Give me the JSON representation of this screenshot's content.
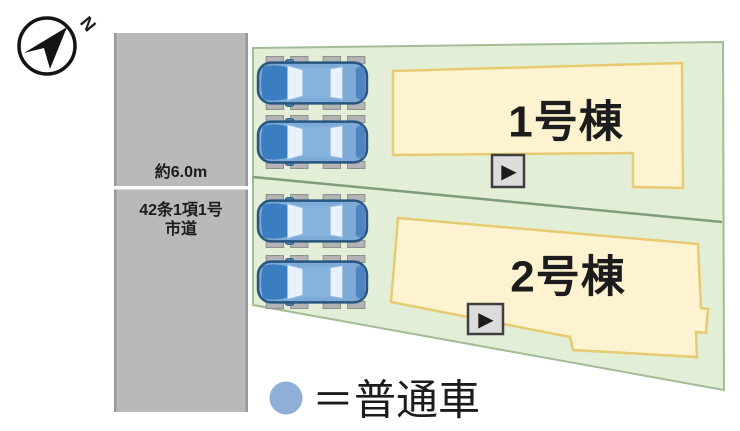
{
  "compass": {
    "north_label": "N"
  },
  "road": {
    "width_label": "約6.0m",
    "designation_line1": "42条1項1号",
    "designation_line2": "市道"
  },
  "buildings": [
    {
      "label": "1号棟"
    },
    {
      "label": "2号棟"
    }
  ],
  "parking": {
    "car_count": 4
  },
  "legend": {
    "text": "＝普通車"
  },
  "icons": {
    "play": "▶",
    "north_arrow": "navigation-arrow",
    "car": "car-top-view"
  },
  "colors": {
    "road_gray": "#b9b9b9",
    "road_edge_gray": "#989898",
    "road_centerline": "#ffffff",
    "plot_green": "#e3eed6",
    "plot_border_green": "#a4bc96",
    "divider_green": "#7f9d78",
    "building_cream": "#fdf3d0",
    "building_border_yellow": "#e7cb72",
    "button_gray": "#dcdcdc",
    "button_border": "#3f3f3f",
    "car_blue": "#7eaad9",
    "legend_circle_blue": "#8fafd8",
    "text_black": "#1c1c1c"
  }
}
